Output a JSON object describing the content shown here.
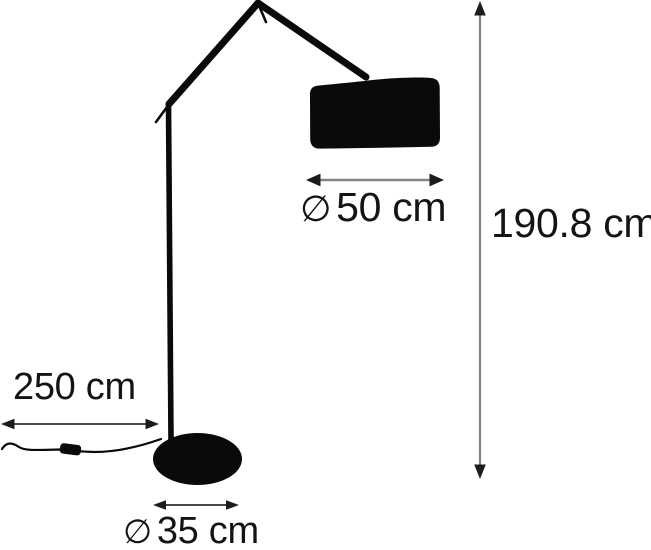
{
  "page": {
    "title": "Floor lamp dimension diagram",
    "background": "#ffffff"
  },
  "colors": {
    "lamp": "#0a0a0a",
    "dim_gray": "#858585",
    "dim_dark": "#2e2e2e",
    "arrowhead": "#1c1c1c",
    "label": "#141414"
  },
  "labels": {
    "shade_diameter": {
      "symbol": "∅",
      "value": "50 cm"
    },
    "height": {
      "value": "190.8 cm"
    },
    "cord_length": {
      "value": "250 cm"
    },
    "base_diameter": {
      "symbol": "∅",
      "value": "35 cm"
    }
  },
  "dimensions": {
    "shade_diameter_cm": 50,
    "height_cm": 190.8,
    "cord_length_cm": 250,
    "base_diameter_cm": 35
  }
}
